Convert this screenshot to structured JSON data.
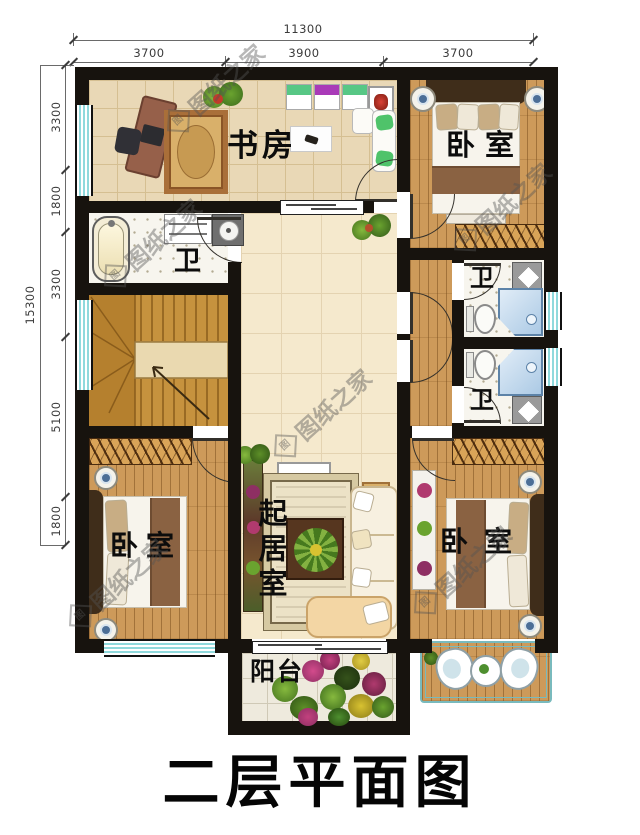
{
  "title": "二层平面图",
  "watermark": {
    "logo_char": "图",
    "text": "图纸之家"
  },
  "dimensions": {
    "top": {
      "total": "11300",
      "segments": [
        "3700",
        "3900",
        "3700"
      ]
    },
    "left": {
      "total": "15300",
      "segments": [
        "3300",
        "1800",
        "3300",
        "5100",
        "1800"
      ]
    }
  },
  "rooms": {
    "study": "书房",
    "bedroom_top_right": "卧室",
    "bathroom_left": "卫",
    "bathroom_right_upper": "卫",
    "bathroom_right_lower": "卫",
    "living_room": "起居室",
    "bedroom_bottom_left": "卧室",
    "bedroom_bottom_right": "卧室",
    "balcony": "阳台"
  }
}
